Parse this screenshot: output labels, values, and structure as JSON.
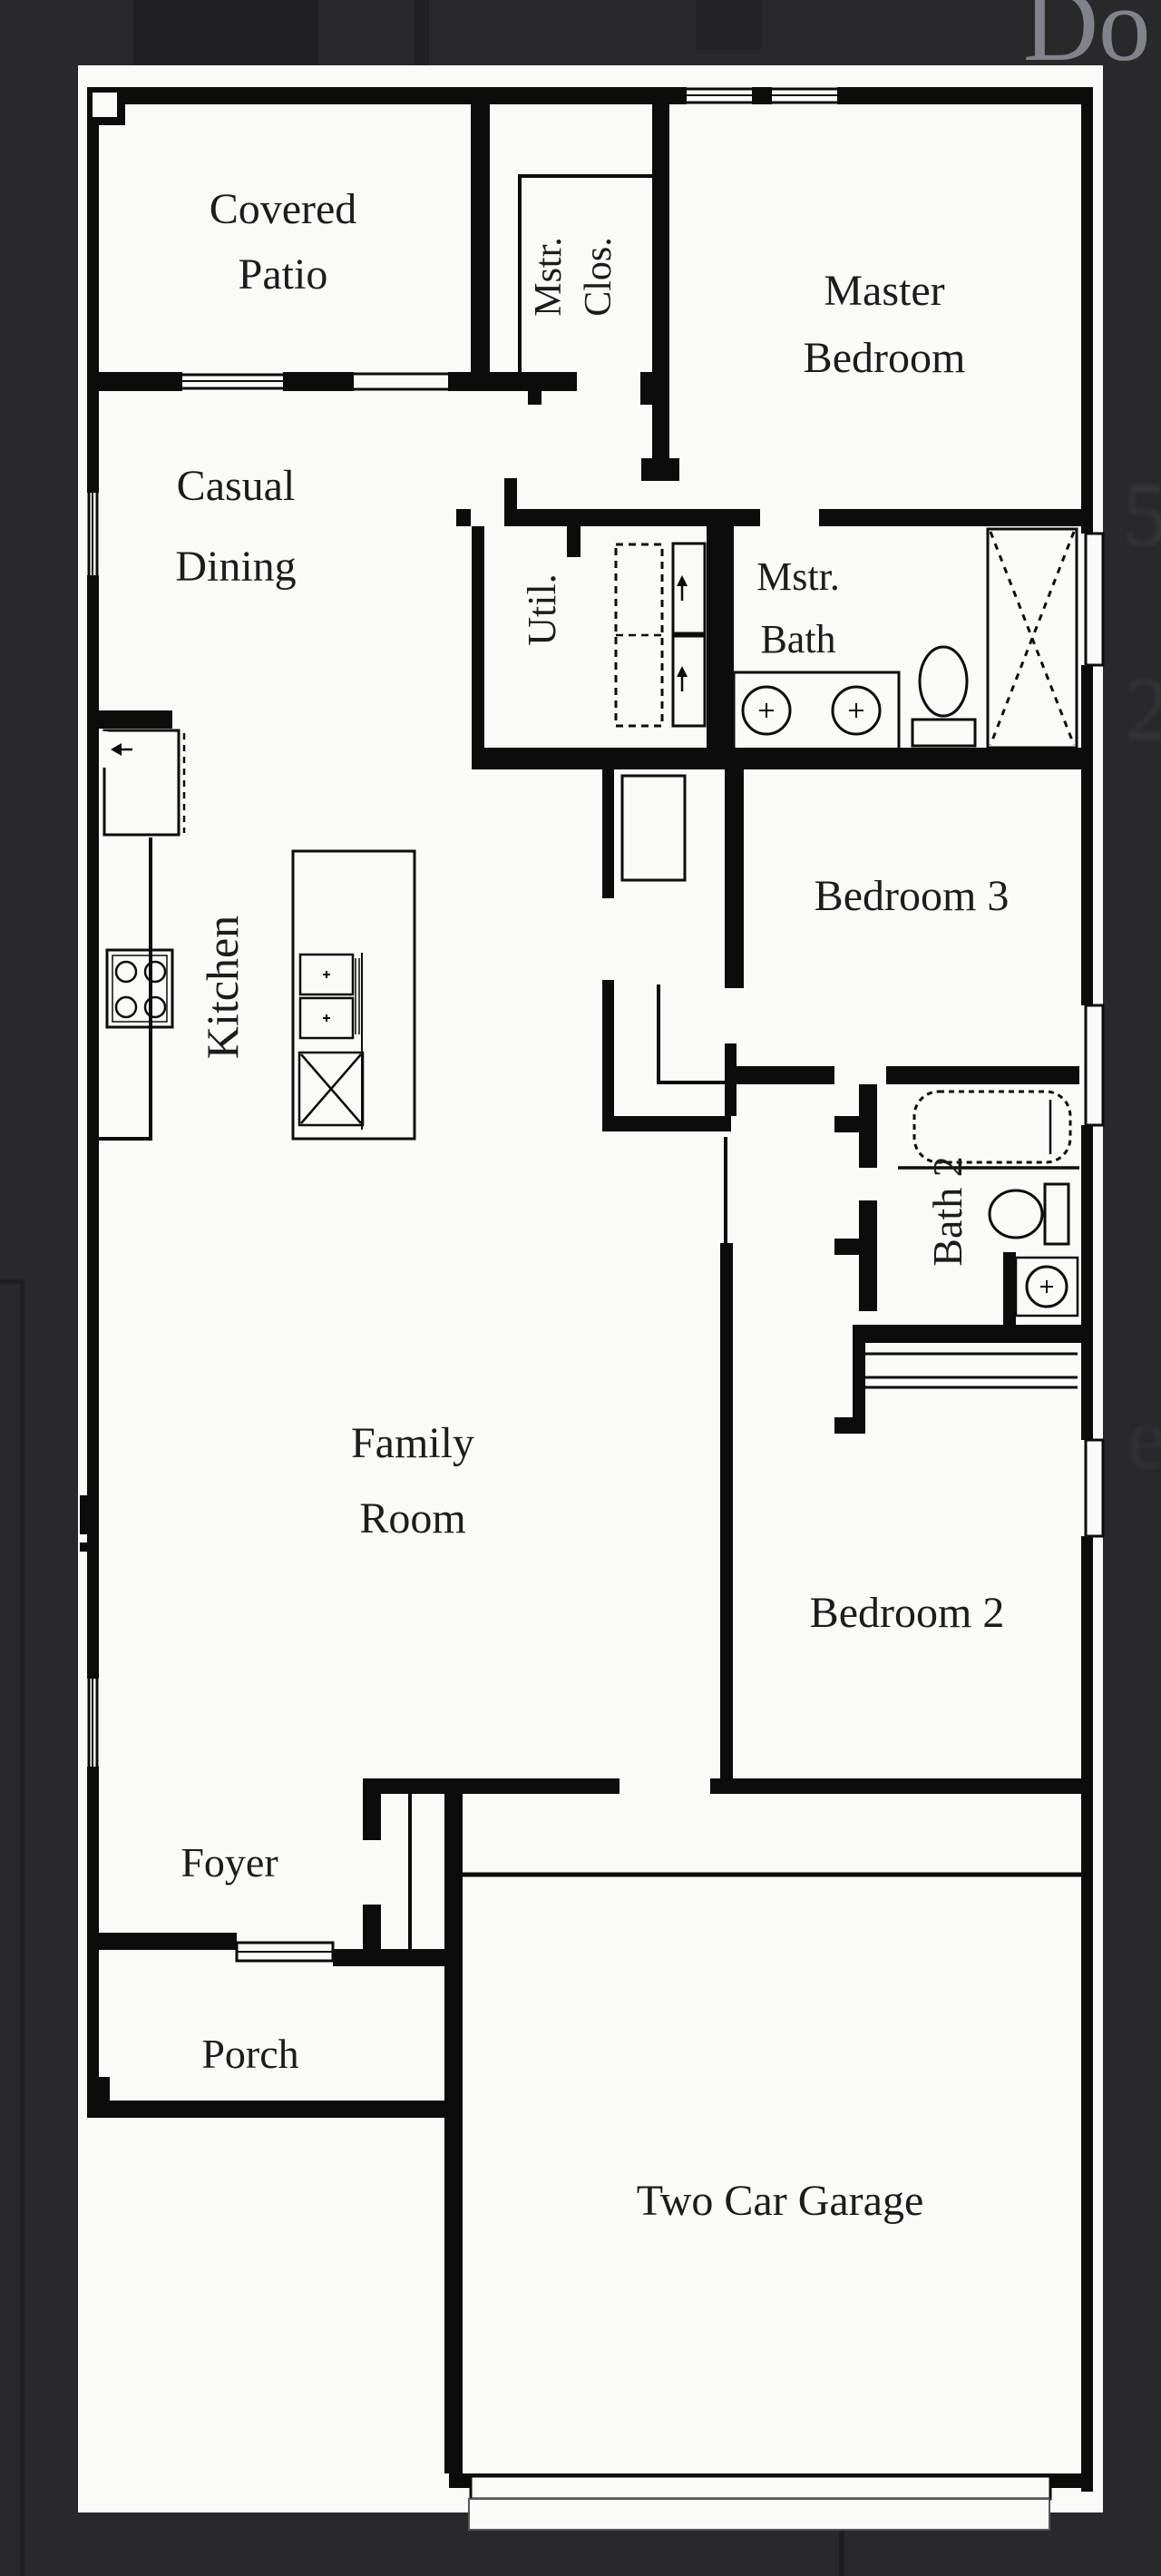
{
  "scene": {
    "type": "architectural-floor-plan",
    "description": "Single-story house floor plan, black line drawing on white sheet over dark background"
  },
  "colors": {
    "background": "#29292b",
    "background_shadow": "#202023",
    "paper": "#fafaf8",
    "wall": "#0c0c0c",
    "label_text": "#1c1c1c",
    "faint_edge_glyph": "#38383c",
    "cutoff_text_top_right": "#82828a"
  },
  "rooms": {
    "covered_patio": {
      "line1": "Covered",
      "line2": "Patio"
    },
    "master_closet": {
      "line1": "Mstr.",
      "line2": "Clos."
    },
    "master_bedroom": {
      "line1": "Master",
      "line2": "Bedroom"
    },
    "casual_dining": {
      "line1": "Casual",
      "line2": "Dining"
    },
    "utility": {
      "label": "Util."
    },
    "master_bath": {
      "line1": "Mstr.",
      "line2": "Bath"
    },
    "kitchen": {
      "label": "Kitchen"
    },
    "bedroom_3": {
      "label": "Bedroom 3"
    },
    "bath_2": {
      "label": "Bath 2"
    },
    "family_room": {
      "line1": "Family",
      "line2": "Room"
    },
    "bedroom_2": {
      "label": "Bedroom 2"
    },
    "foyer": {
      "label": "Foyer"
    },
    "porch": {
      "label": "Porch"
    },
    "garage": {
      "label": "Two Car Garage"
    }
  },
  "fixtures": [
    "corner-pantry",
    "cooktop",
    "kitchen-island",
    "range",
    "kitchen-sink",
    "utility-appliance-space",
    "washer-dryer",
    "double-vanity-sinks",
    "toilet-master",
    "shower",
    "bathtub",
    "toilet-bath2",
    "bathroom-sink",
    "bedroom2-closet-shelves",
    "linen-closet",
    "coat-closet",
    "entry-door",
    "garage-door",
    "windows"
  ],
  "background_fragments": {
    "top_right_text": "Do",
    "right_edge_glyphs": [
      "5",
      "2",
      "e"
    ]
  }
}
